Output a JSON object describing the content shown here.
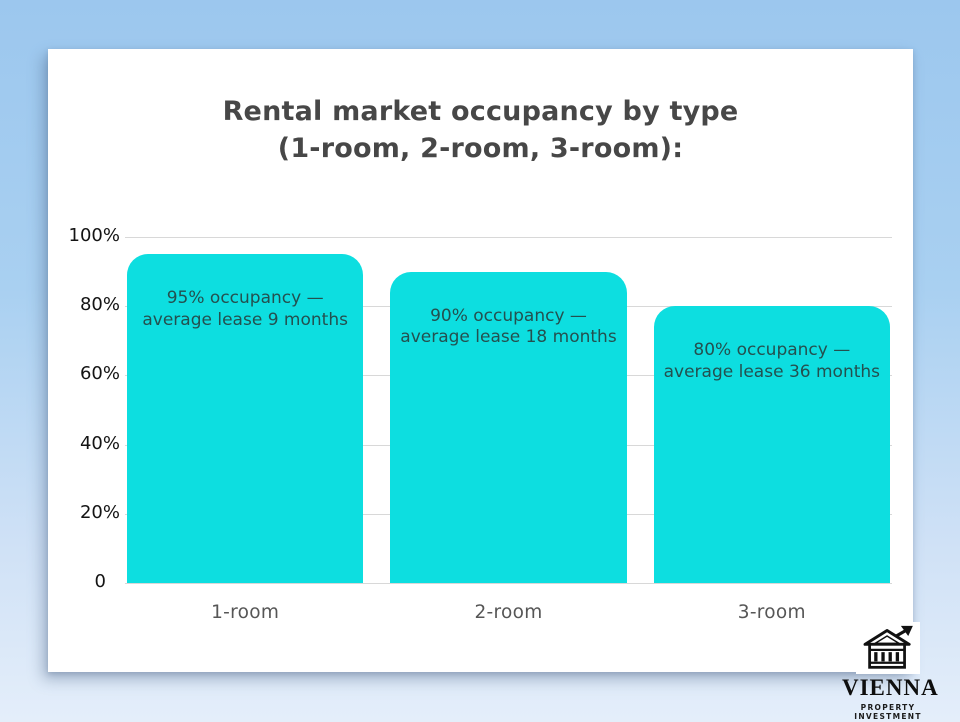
{
  "page": {
    "background_top": "#9cc7ee",
    "background_bottom": "#e4eefa"
  },
  "chart_data": {
    "type": "bar",
    "title": "Rental market occupancy by type (1-room, 2-room, 3-room):",
    "title_line1": "Rental market occupancy by type",
    "title_line2": "(1-room, 2-room, 3-room):",
    "categories": [
      "1-room",
      "2-room",
      "3-room"
    ],
    "values": [
      95,
      90,
      80
    ],
    "bar_annotations": [
      {
        "line1": "95% occupancy —",
        "line2": "average lease 9 months"
      },
      {
        "line1": "90% occupancy —",
        "line2": "average lease 18 months"
      },
      {
        "line1": "80% occupancy —",
        "line2": "average lease 36 months"
      }
    ],
    "y_ticks": [
      {
        "label": "100%",
        "value": 100
      },
      {
        "label": "80%",
        "value": 80
      },
      {
        "label": "60%",
        "value": 60
      },
      {
        "label": "40%",
        "value": 40
      },
      {
        "label": "20%",
        "value": 20
      },
      {
        "label": "0",
        "value": 0
      }
    ],
    "ylim": [
      0,
      100
    ],
    "grid": true,
    "legend_position": "none",
    "bar_color": "#0ddee0",
    "xlabel": "",
    "ylabel": ""
  },
  "logo": {
    "icon": "bank-building-with-growth-arrow",
    "name": "VIENNA",
    "subtitle": "PROPERTY INVESTMENT"
  }
}
